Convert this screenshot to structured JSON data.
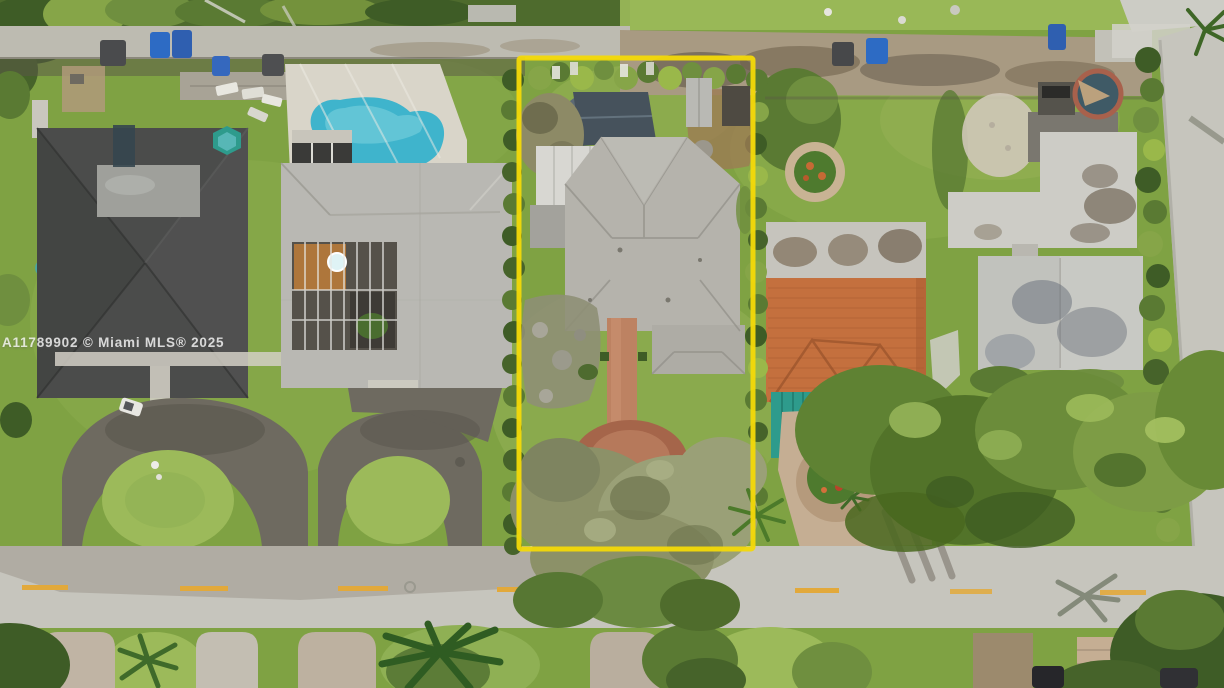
{
  "scene": {
    "type": "aerial-photograph",
    "description": "Aerial drone view of a residential neighborhood; one lot outlined with a yellow property boundary",
    "watermark": "A11789902 © Miami MLS® 2025"
  },
  "highlight": {
    "label": "property-boundary",
    "color": "#F3D908"
  },
  "palette": {
    "grass_base": "#7FA243",
    "grass_light": "#9CBA5A",
    "grass_pale": "#B7CC79",
    "grass_dark": "#5D7F33",
    "veg_dark": "#3E5C26",
    "veg_mid": "#5A7A33",
    "veg_bright": "#86A548",
    "canopy_olive": "#8C9168",
    "canopy_sage": "#9AA077",
    "road": "#C6C5BD",
    "road_dark": "#ADACA3",
    "alley": "#BDBBB1",
    "dirt": "#9C7C54",
    "asphalt": "#6E6A60",
    "asphalt_dark": "#57544B",
    "roof_charcoal": "#4B4C4B",
    "roof_slate": "#46525C",
    "roof_gray": "#B9B8B3",
    "roof_light": "#B5B3AC",
    "roof_pale": "#D8D7D2",
    "roof_white": "#CDCCC6",
    "roof_orange": "#C4703E",
    "roof_orange_dark": "#A85A30",
    "pool": "#3FB4CC",
    "pool_light": "#7FD4DF",
    "deck": "#D9D5C9",
    "awning": "#2E9B8C",
    "paver": "#C5AE93",
    "walk_red": "#BD8262",
    "centerline": "#E2A93B",
    "bin_blue": "#2D6BC4",
    "stain": "#8A7D6A"
  }
}
